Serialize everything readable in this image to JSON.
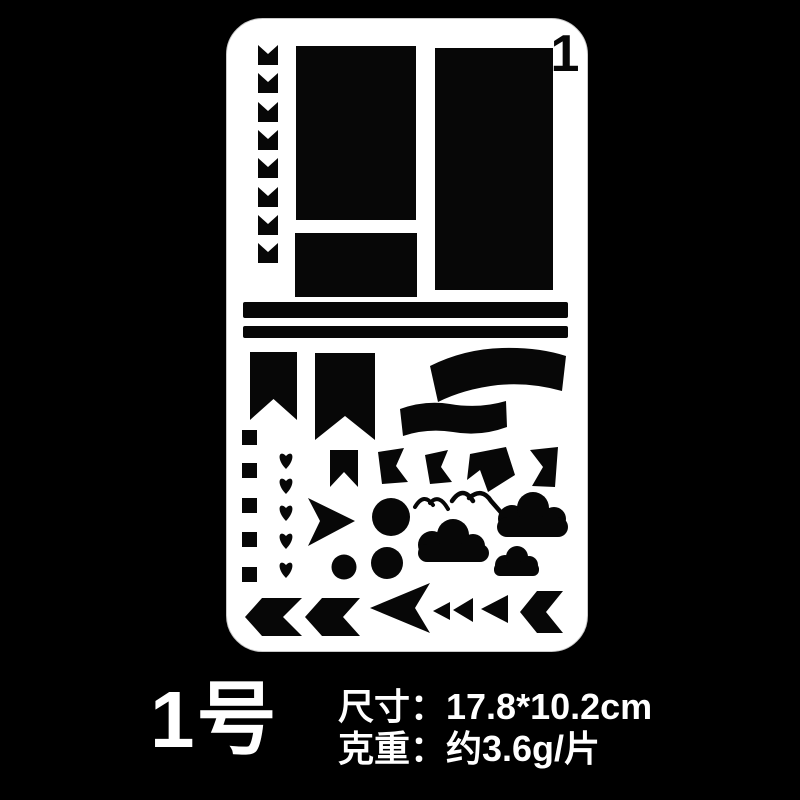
{
  "colors": {
    "background": "#000000",
    "sheet": "#ffffff",
    "cutout": "#070707",
    "caption_text": "#ffffff"
  },
  "sheet": {
    "corner_number": "1",
    "shapes": [
      {
        "name": "chevron-tab",
        "count": 8
      },
      {
        "name": "large-rectangle",
        "count": 1
      },
      {
        "name": "small-rectangle",
        "count": 1
      },
      {
        "name": "tall-rectangle",
        "count": 1
      },
      {
        "name": "divider-bar",
        "count": 2
      },
      {
        "name": "pennant-flag",
        "count": 2
      },
      {
        "name": "ribbon-banner",
        "count": 2
      },
      {
        "name": "square-dot",
        "count": 5
      },
      {
        "name": "heart",
        "count": 5
      },
      {
        "name": "bookmark-flag",
        "count": 1
      },
      {
        "name": "waving-flag",
        "count": 4
      },
      {
        "name": "arrow-right",
        "count": 1
      },
      {
        "name": "circle",
        "count": 3
      },
      {
        "name": "bird",
        "count": 2
      },
      {
        "name": "cloud",
        "count": 3
      },
      {
        "name": "chevron-arrow-left",
        "count": 3
      },
      {
        "name": "swallowtail-arrow-left",
        "count": 1
      },
      {
        "name": "triangle-left",
        "count": 3
      }
    ]
  },
  "caption": {
    "model": "1号",
    "size_label": "尺寸：",
    "size_value": "17.8*10.2cm",
    "weight_label": "克重：",
    "weight_value": "约3.6g/片"
  }
}
